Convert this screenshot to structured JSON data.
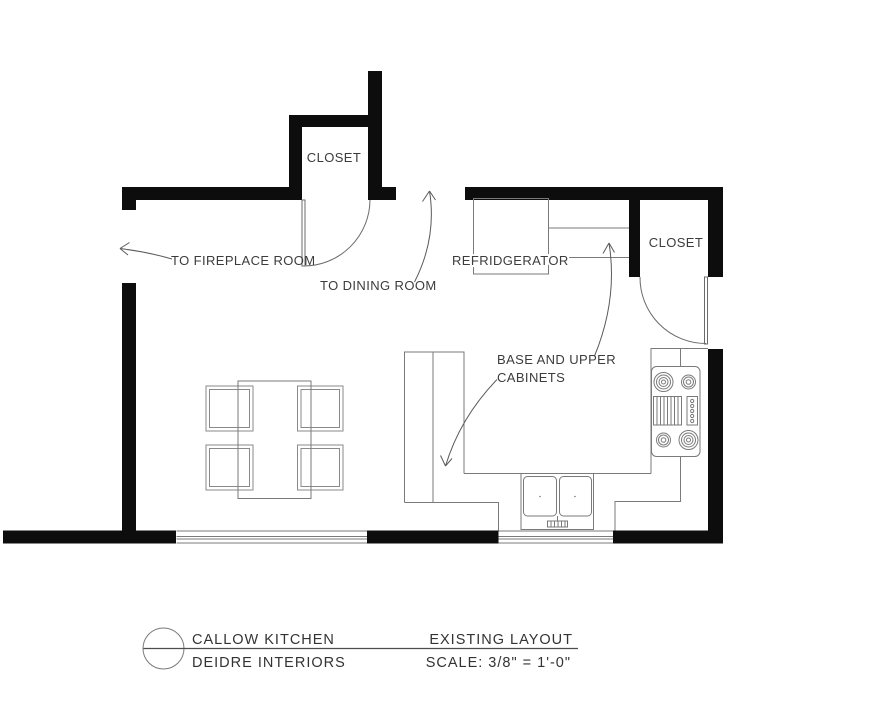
{
  "plan": {
    "rooms": {
      "closet_top": "CLOSET",
      "closet_right": "CLOSET"
    },
    "annotations": {
      "to_fireplace": "TO FIREPLACE ROOM",
      "to_dining": "TO DINING ROOM",
      "refrigerator": "REFRIDGERATOR",
      "cabinets_line1": "BASE AND UPPER",
      "cabinets_line2": "CABINETS"
    },
    "fixtures": [
      "refrigerator",
      "stove-4-burner-with-griddle",
      "double-sink",
      "dining-table-4-chairs",
      "base-and-upper-cabinets",
      "two-windows",
      "two-closet-doors"
    ]
  },
  "title_block": {
    "project_name": "CALLOW KITCHEN",
    "company": "DEIDRE INTERIORS",
    "drawing_title": "EXISTING LAYOUT",
    "scale": "SCALE: 3/8\" = 1'-0\""
  },
  "colors": {
    "wall": "#0d0d0d",
    "furniture_line": "#7a7a7a",
    "door_line": "#6b6b6b",
    "annotation_text": "#3c3c3c",
    "background": "#ffffff"
  }
}
